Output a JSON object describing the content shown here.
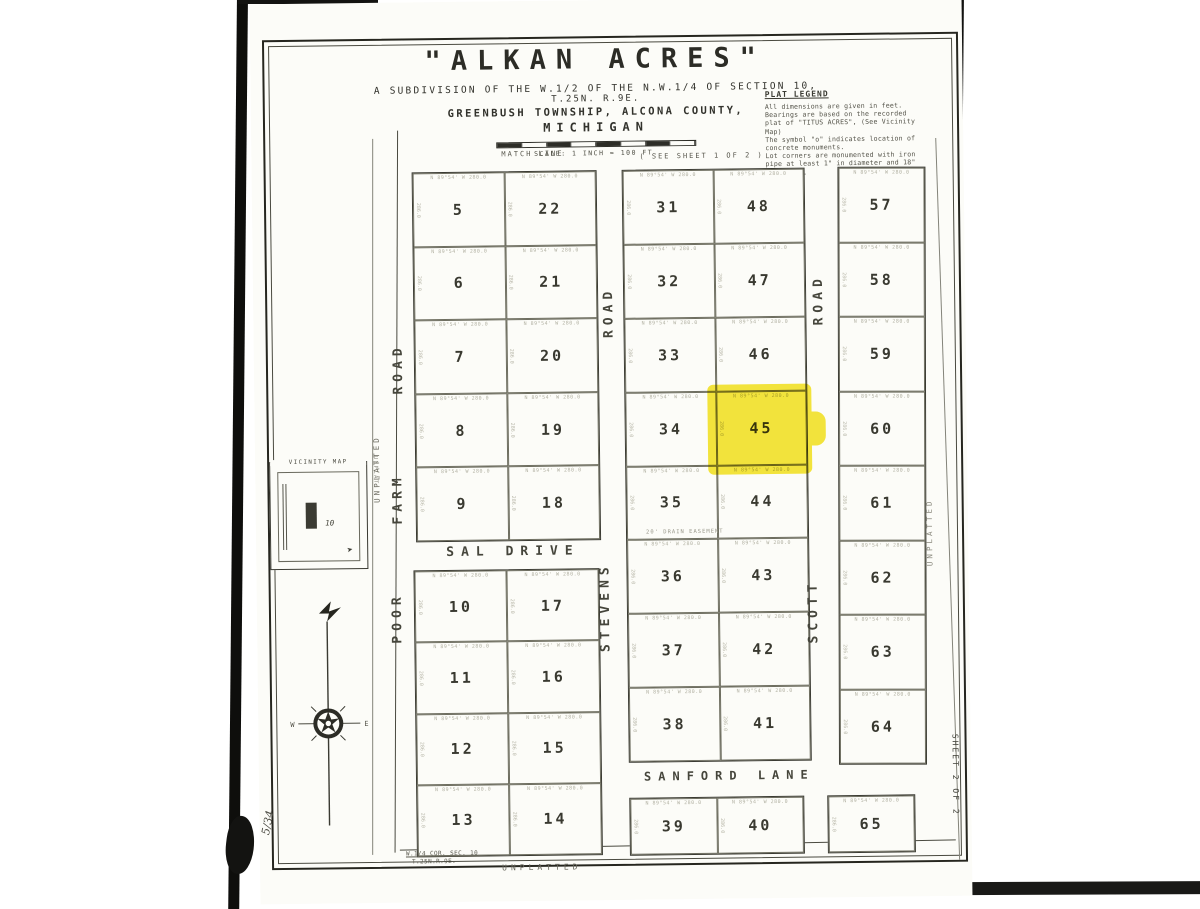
{
  "title_block": {
    "title": "\"ALKAN   ACRES\"",
    "subtitle1": "A  SUBDIVISION  OF  THE W.1/2 OF THE  N.W.1/4  OF  SECTION   10,",
    "subtitle2": "T.25N. R.9E.",
    "subtitle3": "GREENBUSH  TOWNSHIP,  ALCONA  COUNTY,",
    "subtitle4": "MICHIGAN",
    "scale_label": "SCALE: 1 INCH = 100 FT."
  },
  "legend": {
    "title": "PLAT LEGEND",
    "lines": [
      "All dimensions are given in feet.",
      "Bearings are based on the recorded",
      "plat of \"TITUS ACRES\", (See Vicinity",
      "Map)",
      "The symbol \"o\" indicates location of",
      "concrete monuments.",
      "Lot corners are monumented with iron",
      "pipe at least 1\" in diameter and 18\"",
      "in length."
    ]
  },
  "map": {
    "match_line_label": "MATCH  LINE",
    "see_sheet_label": "( SEE  SHEET  1  OF  2 )",
    "unplatted": "UNPLATTED",
    "corner_note1": "W.1/4 COR. SEC. 10",
    "corner_note2": "T.25N.R.9E.",
    "easement_note": "20' DRAIN  EASEMENT",
    "annotation": "N 89°54' W   280.0",
    "annotation_dim": "286.0",
    "highlighted_lot": "45",
    "roads": {
      "poor_farm": [
        "POOR",
        "FARM",
        "ROAD"
      ],
      "stevens": [
        "STEVENS",
        "ROAD"
      ],
      "scott": [
        "SCOTT",
        "ROAD"
      ],
      "sal": "SAL   DRIVE",
      "sanford": "SANFORD   LANE"
    },
    "blocks": {
      "left_upper_rows": [
        [
          "5",
          "22"
        ],
        [
          "6",
          "21"
        ],
        [
          "7",
          "20"
        ],
        [
          "8",
          "19"
        ],
        [
          "9",
          "18"
        ]
      ],
      "left_lower_rows": [
        [
          "10",
          "17"
        ],
        [
          "11",
          "16"
        ],
        [
          "12",
          "15"
        ],
        [
          "13",
          "14"
        ]
      ],
      "middle_rows": [
        [
          "31",
          "48"
        ],
        [
          "32",
          "47"
        ],
        [
          "33",
          "46"
        ],
        [
          "34",
          "45"
        ],
        [
          "35",
          "44"
        ],
        [
          "36",
          "43"
        ],
        [
          "37",
          "42"
        ],
        [
          "38",
          "41"
        ]
      ],
      "middle_bottom_row": [
        [
          "39",
          "40"
        ]
      ],
      "right_rows": [
        [
          "57"
        ],
        [
          "58"
        ],
        [
          "59"
        ],
        [
          "60"
        ],
        [
          "61"
        ],
        [
          "62"
        ],
        [
          "63"
        ],
        [
          "64"
        ]
      ],
      "right_bottom_row": [
        [
          "65"
        ]
      ]
    }
  },
  "vicinity": {
    "title": "VICINITY  MAP",
    "section_label": "10",
    "side_label": "UNPLAT-",
    "arrow": "➤"
  },
  "compass": {
    "north": "N",
    "west": "W",
    "east": "E"
  },
  "page": {
    "sheet_label": "SHEET 2 OF 2",
    "handwritten_note": "5/34"
  },
  "colors": {
    "highlight": "#f3e112",
    "ink": "#32322c"
  }
}
